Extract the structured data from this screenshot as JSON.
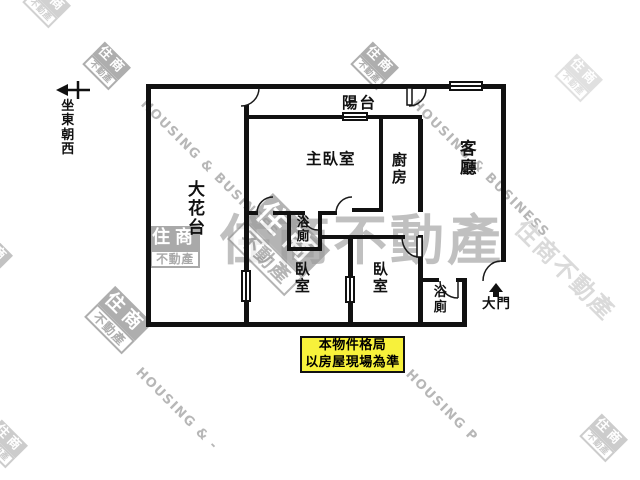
{
  "compass": {
    "direction_label": "坐東朝西"
  },
  "rooms": {
    "flower_terrace": "大花台",
    "balcony": "陽台",
    "master_bedroom": "主臥室",
    "kitchen": "廚房",
    "living_room": "客廳",
    "bathroom_1": "浴廁",
    "bathroom_2": "浴廁",
    "bedroom_1": "臥室",
    "bedroom_2": "臥室"
  },
  "entrance": {
    "label": "大門"
  },
  "notice": {
    "line1": "本物件格局",
    "line2": "以房屋現場為準",
    "bg_color": "#F7F13B",
    "border_color": "#111111"
  },
  "watermarks": {
    "brand_box_top": "住商",
    "brand_box_bottom": "不動產",
    "brand_full": "住商不動產",
    "diagonal_top_left": "HOUSING & BUSINESS",
    "diagonal_top_right": "HOUSING & BUSINESS",
    "diagonal_bottom_left": "HOUSING & -",
    "diagonal_bottom_right": "HOUSING P",
    "gray": "#9b9b9b",
    "light_gray": "#c0c0c0"
  },
  "colors": {
    "wall": "#111111",
    "door_arc": "#1a1a1a",
    "background": "#ffffff"
  }
}
